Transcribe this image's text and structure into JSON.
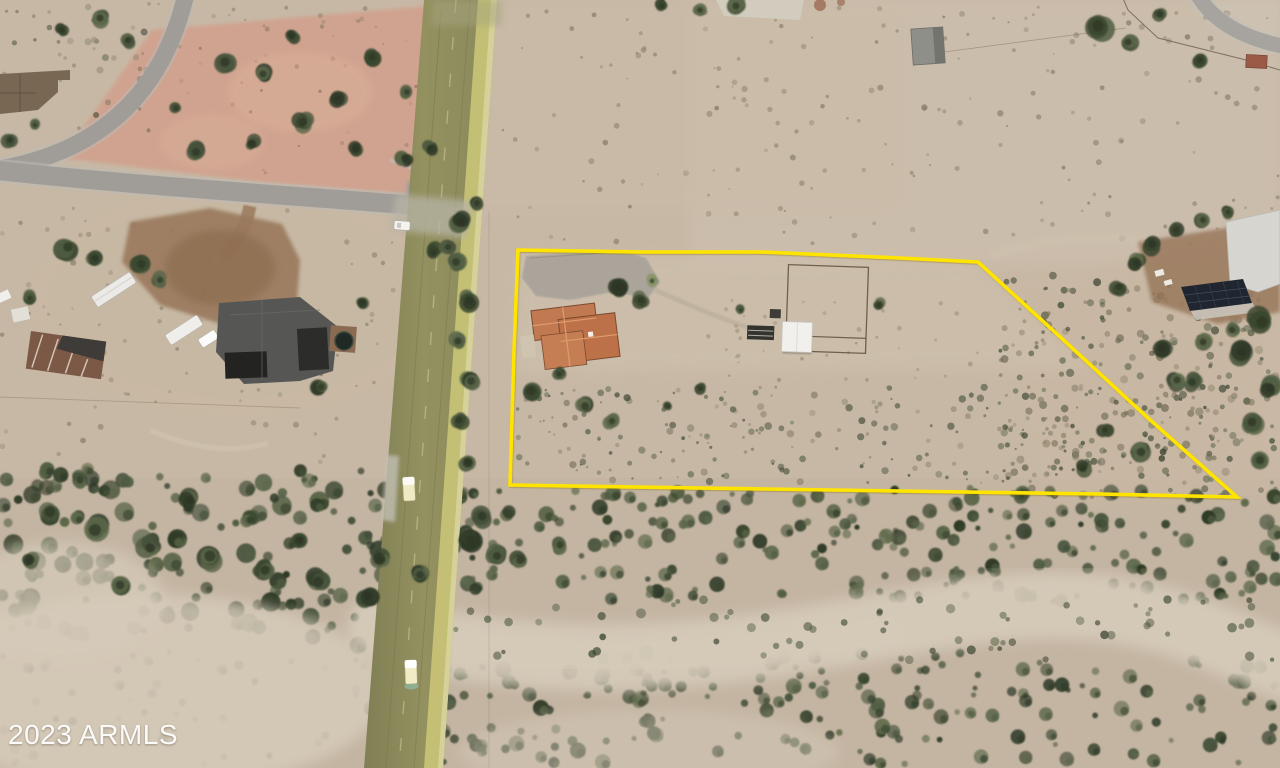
{
  "watermark": {
    "text": "2023 ARMLS"
  },
  "map": {
    "view": "aerial-satellite-photo",
    "subject_parcel": {
      "outline_color": "#ffe400",
      "outline_px": [
        [
          518,
          250
        ],
        [
          642,
          252
        ],
        [
          762,
          252
        ],
        [
          900,
          258
        ],
        [
          978,
          262
        ],
        [
          1058,
          335
        ],
        [
          1148,
          418
        ],
        [
          1237,
          497
        ],
        [
          1100,
          494
        ],
        [
          900,
          491
        ],
        [
          700,
          488
        ],
        [
          510,
          485
        ],
        [
          512,
          418
        ],
        [
          514,
          350
        ],
        [
          516,
          300
        ]
      ]
    },
    "features": [
      "subject-parcel-boundary",
      "two-lane-highway",
      "residential-streets",
      "subject-house-tile-roof",
      "corral-with-sheds",
      "neighbor-house-west",
      "neighbor-house-northeast-solar",
      "rv-trailers",
      "desert-wash-vegetation",
      "vehicles-on-highway"
    ],
    "colors": {
      "desert": "#c7b8a5",
      "desertLight": "#cfc2ae",
      "pinkLot": "#d0a28e",
      "roadGray": "#a09d99",
      "hwyOlive": "#8d8c5f",
      "hwyShoulder": "#cdc878",
      "vegDark": "#45513b",
      "vegMid": "#5d684a",
      "washSand": "#d6cbba",
      "dirtBrown": "#9a795d",
      "roofOrange": "#c0784f",
      "roofGray": "#565654",
      "roofTaupe": "#786753",
      "solarPanel": "#20262f",
      "structWhite": "#f1f0ec",
      "redBrown": "#9a5a46",
      "boundaryYellow": "#ffe400"
    }
  }
}
